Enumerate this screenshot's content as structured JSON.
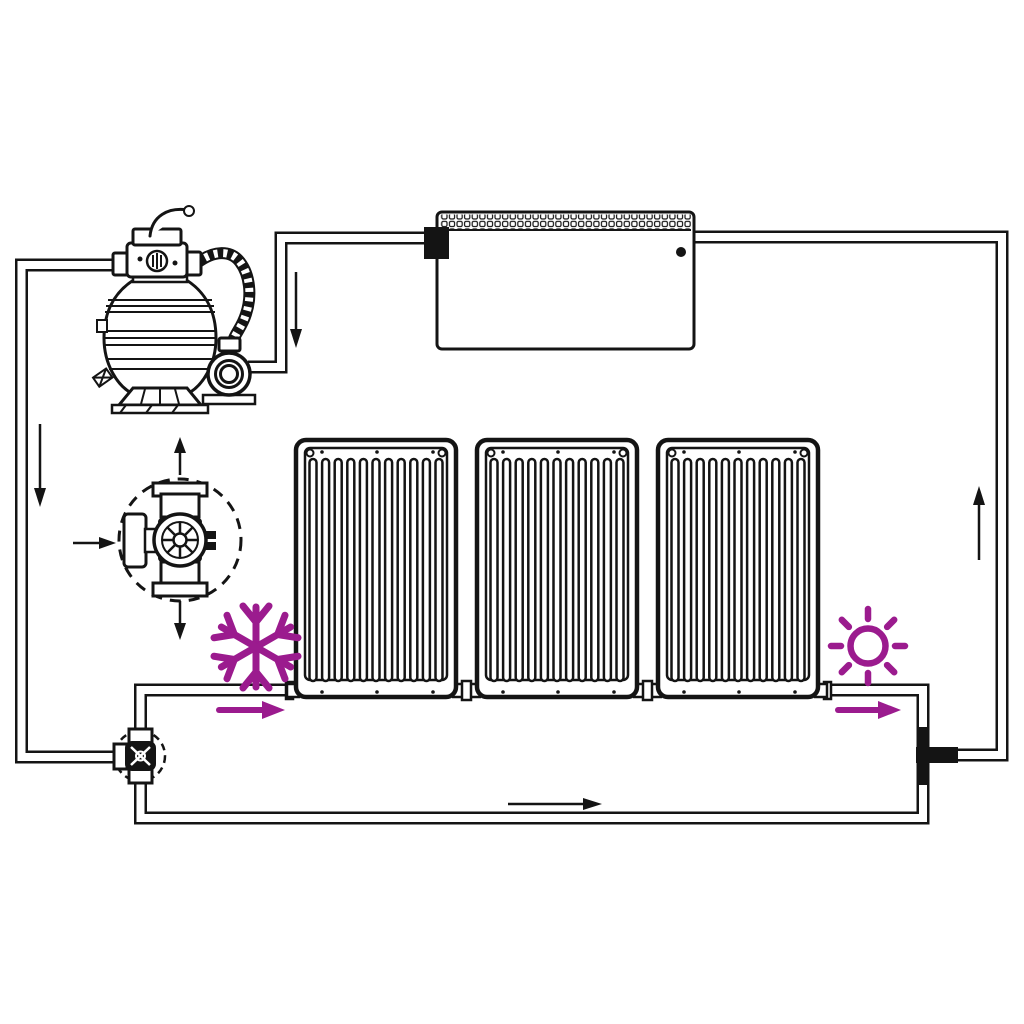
{
  "colors": {
    "ink": "#141414",
    "accent": "#9b1b8e",
    "background": "#ffffff"
  },
  "diagram": {
    "kind": "schematic",
    "subject": "solar-pool-heating-circuit"
  },
  "components": [
    {
      "name": "sand-filter-pump"
    },
    {
      "name": "multiport-valve"
    },
    {
      "name": "pump-motor"
    },
    {
      "name": "swimming-pool"
    },
    {
      "name": "solar-heating-panel",
      "count": 3
    },
    {
      "name": "three-way-valve-detail-view"
    },
    {
      "name": "bypass-three-way-valve"
    },
    {
      "name": "piping-loop"
    }
  ],
  "icons": [
    {
      "name": "snowflake-icon",
      "color": "#9b1b8e"
    },
    {
      "name": "sun-icon",
      "color": "#9b1b8e"
    }
  ],
  "flow_arrows": [
    {
      "name": "flow-down-left-pipe",
      "direction": "down",
      "color": "#141414"
    },
    {
      "name": "flow-down-pool-to-pump",
      "direction": "down",
      "color": "#141414"
    },
    {
      "name": "flow-right-bottom-pipe",
      "direction": "right",
      "color": "#141414"
    },
    {
      "name": "flow-up-right-riser",
      "direction": "up",
      "color": "#141414"
    },
    {
      "name": "valve-inlet-arrow",
      "direction": "right",
      "color": "#141414"
    },
    {
      "name": "valve-outlet-up-arrow",
      "direction": "up",
      "color": "#141414"
    },
    {
      "name": "valve-outlet-down-arrow",
      "direction": "down",
      "color": "#141414"
    },
    {
      "name": "winter-flow-arrow",
      "direction": "right",
      "color": "#9b1b8e"
    },
    {
      "name": "summer-flow-arrow",
      "direction": "right",
      "color": "#9b1b8e"
    }
  ]
}
